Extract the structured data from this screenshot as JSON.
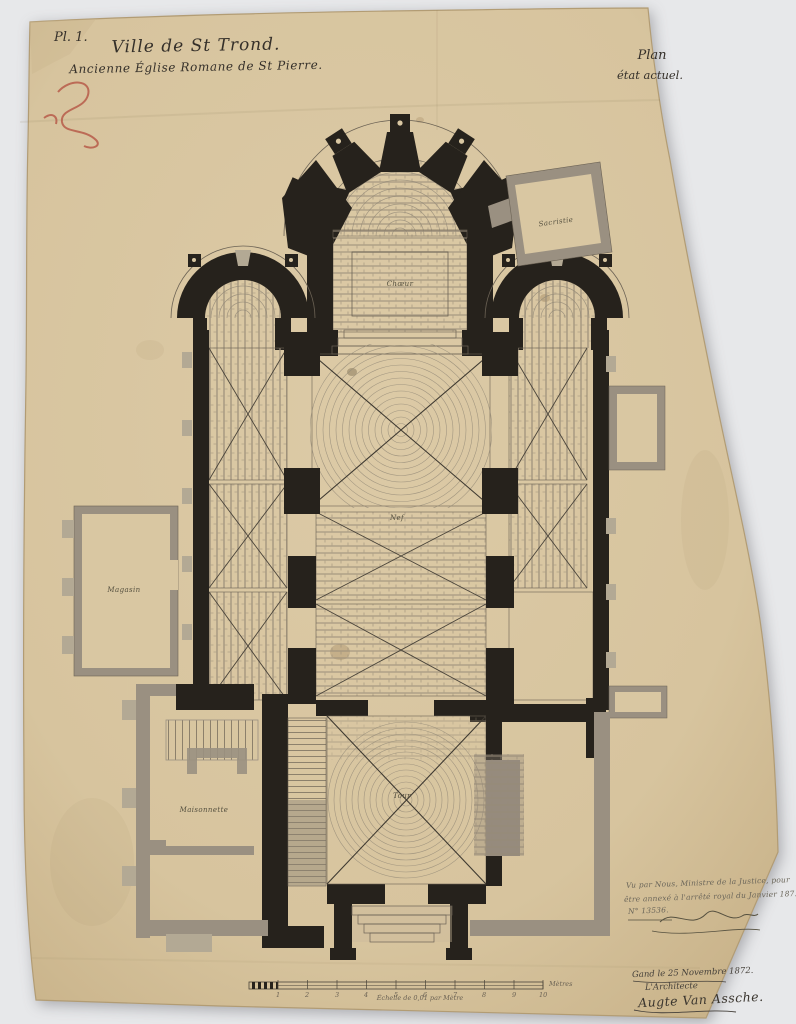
{
  "palette": {
    "background": "#e7e8ea",
    "paper": "#d9c7a2",
    "ink": "#26221c",
    "grey_wash": "#9a9081",
    "grey_light": "#b3a994",
    "red_mark": "#b85c4a"
  },
  "header": {
    "plate": "Pl. 1.",
    "title_line1": "Ville de St Trond.",
    "title_line2": "Ancienne Église Romane de St Pierre.",
    "right_line1": "Plan",
    "right_line2": "état actuel."
  },
  "plan_labels": {
    "sacristie": "Sacristie",
    "choeur": "Chœur",
    "magasin": "Magasin",
    "nef": "Nef",
    "maisonnette": "Maisonnette",
    "tour": "Tour"
  },
  "approval_note": {
    "line1": "Vu par Nous, Ministre de la Justice, pour",
    "line2": "être annexé à l'arrêté royal du Janvier 187.",
    "line3": "N° 13536."
  },
  "signature_block": {
    "date_line": "Gand le 25 Novembre 1872.",
    "role_line": "L'Architecte",
    "name_line": "Augte Van Assche."
  },
  "scalebar": {
    "ticks": [
      "1",
      "2",
      "3",
      "4",
      "5",
      "6",
      "7",
      "8",
      "9",
      "10"
    ],
    "unit_label": "Mètres",
    "caption": "Échelle de 0,01 par Mètre"
  }
}
